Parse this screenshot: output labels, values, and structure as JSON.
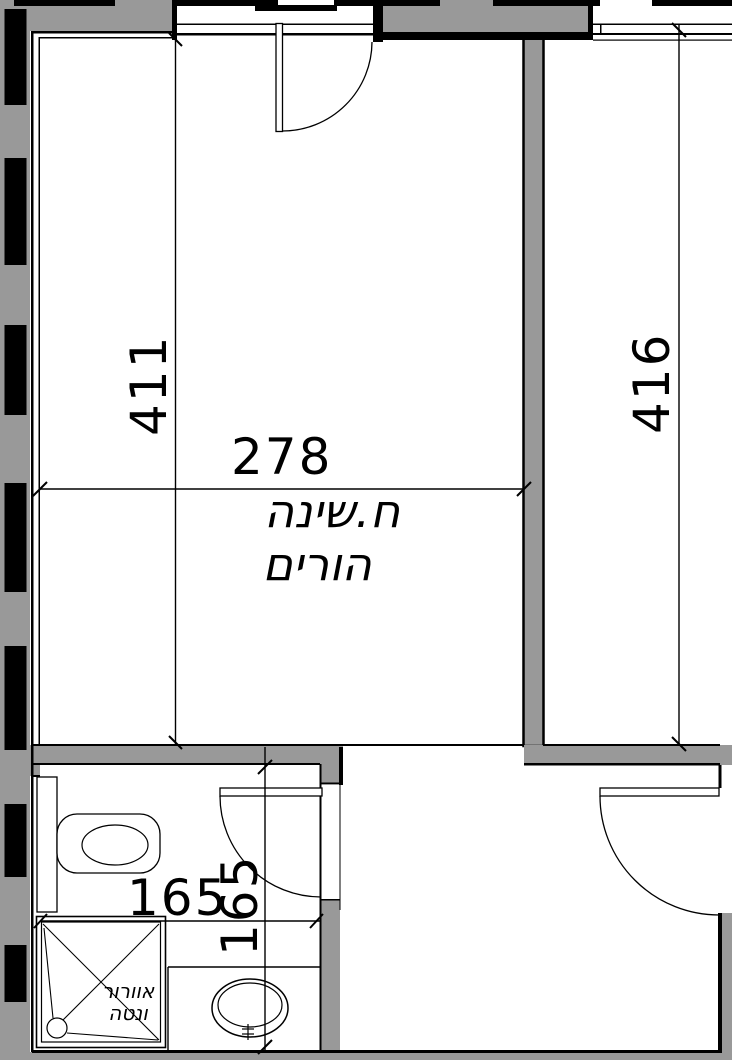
{
  "plan": {
    "type_label": "architectural-floor-plan",
    "colors": {
      "wall_fill": "#999999",
      "line": "#000000",
      "background": "#ffffff"
    },
    "room": {
      "label_line1": "ח.שינה",
      "label_line2": "הורים"
    },
    "bathroom": {
      "shower_label_line1": "אוורור",
      "shower_label_line2": "ונטה"
    },
    "dimensions": [
      {
        "id": "dim-411",
        "value": "411",
        "orientation": "vertical"
      },
      {
        "id": "dim-278",
        "value": "278",
        "orientation": "horizontal"
      },
      {
        "id": "dim-416",
        "value": "416",
        "orientation": "vertical"
      },
      {
        "id": "dim-165-h",
        "value": "165",
        "orientation": "horizontal"
      },
      {
        "id": "dim-165-v",
        "value": "165",
        "orientation": "vertical"
      }
    ],
    "fixtures": [
      {
        "name": "toilet"
      },
      {
        "name": "shower"
      },
      {
        "name": "washbasin"
      }
    ]
  }
}
